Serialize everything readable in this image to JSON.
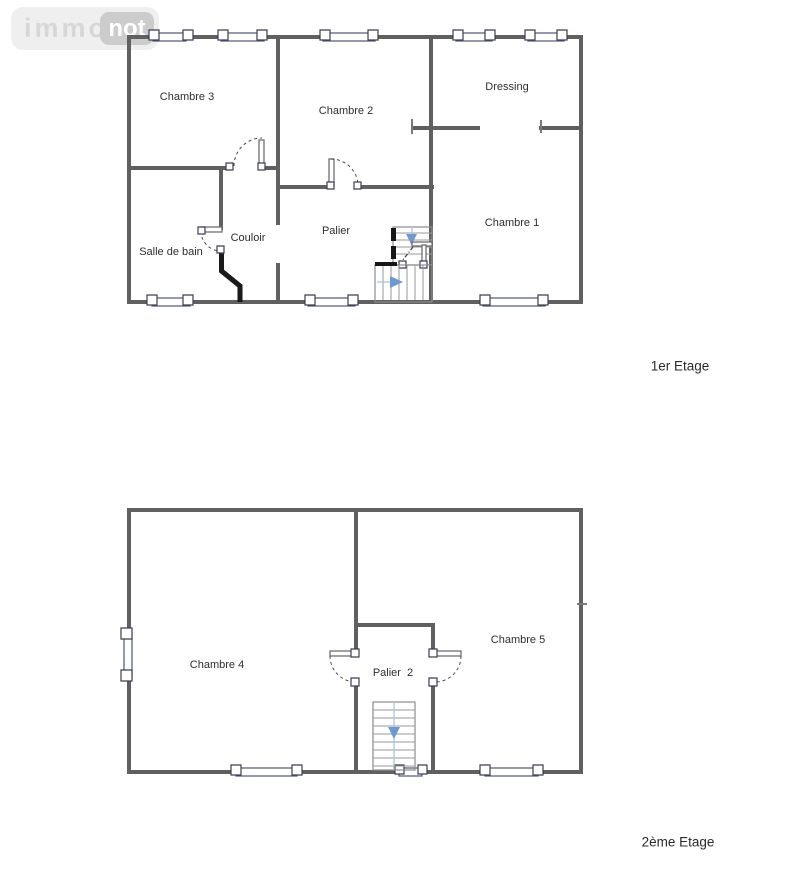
{
  "logo": {
    "immo": "immo",
    "not": "not"
  },
  "colors": {
    "wall": "#606060",
    "black_wall": "#1a1a1a",
    "stair_arrow": "#6b9bd2",
    "stair_walkline": "#aabfdd",
    "window_accent": "#4c5578"
  },
  "floors": [
    {
      "name": "1er Etage",
      "rooms": [
        {
          "label": "Chambre 3"
        },
        {
          "label": "Chambre 2"
        },
        {
          "label": "Dressing"
        },
        {
          "label": "Chambre 1"
        },
        {
          "label": "Salle de bain"
        },
        {
          "label": "Couloir"
        },
        {
          "label": "Palier"
        }
      ]
    },
    {
      "name": "2ème Etage",
      "rooms": [
        {
          "label": "Chambre 4"
        },
        {
          "label": "Palier  2"
        },
        {
          "label": "Chambre 5"
        }
      ]
    }
  ]
}
